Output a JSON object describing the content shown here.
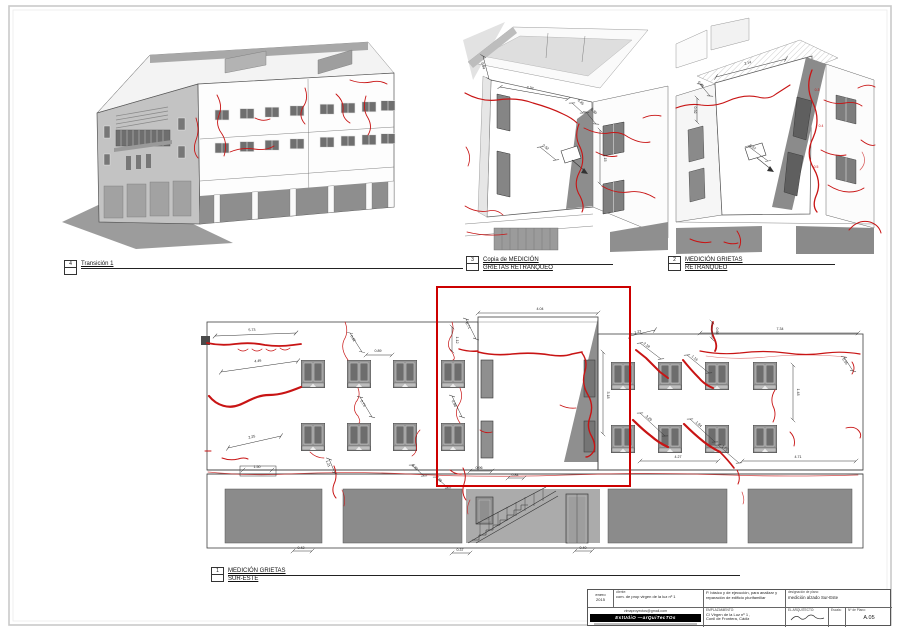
{
  "labels": {
    "view4": {
      "num": "4",
      "line1": "Transición 1",
      "line2": ""
    },
    "view3": {
      "num": "3",
      "line1": "Copia de MEDICIÓN",
      "line2": "GRIETAS RETRANQUEO"
    },
    "view2": {
      "num": "2",
      "line1": "MEDICIÓN GRIETAS",
      "line2": "RETRANQUEO"
    },
    "view1": {
      "num": "1",
      "line1": "MEDICIÓN GRIETAS",
      "line2": "SUR-ESTE"
    }
  },
  "titleblock": {
    "date_line1": "enero",
    "date_line2": "2015",
    "client_label": "cliente:",
    "client": "com. de prop virgen de la luz nº 1",
    "project_line1": "P. básico y de ejecución, para analizar y",
    "project_line2": "reparación de edificio plurifamiliar",
    "designation_label": "designación de plano:",
    "designation": "medición alzado Sur-Este",
    "email": "vimaproyectos@gmail.com",
    "studio": "EstUdiO —arQuiTecTOs",
    "site_label": "EMPLAZAMIENTO:",
    "site_line1": "C/ Virgen de la Luz nº 1 ,",
    "site_line2": "Conil de Frontera, Cádiz",
    "architect_label": "EL ARQUITECTO:",
    "scale_label": "Escala:",
    "sheet_no_label": "Nº de Plano:",
    "sheet_no": "A.05"
  },
  "colors": {
    "crack": "#c81414",
    "highlight": "#cc0000",
    "storefront": "#8b8b8b",
    "frame": "#c9c9c9"
  },
  "dims": {
    "elevation": [
      {
        "x1": 215,
        "y1": 336,
        "x2": 296,
        "y2": 333,
        "lx": 252,
        "ly": 331,
        "r": -2,
        "v": "5.73"
      },
      {
        "x1": 221,
        "y1": 372,
        "x2": 298,
        "y2": 361,
        "lx": 258,
        "ly": 362,
        "r": -8,
        "v": "4.46"
      },
      {
        "x1": 228,
        "y1": 448,
        "x2": 281,
        "y2": 436,
        "lx": 252,
        "ly": 438,
        "r": -13,
        "v": "2.25"
      },
      {
        "x1": 243,
        "y1": 470,
        "x2": 272,
        "y2": 470,
        "lx": 257,
        "ly": 468,
        "r": 0,
        "v": "1.50"
      },
      {
        "x1": 350,
        "y1": 333,
        "x2": 362,
        "y2": 352,
        "lx": 352,
        "ly": 339,
        "r": 60,
        "v": "0.62"
      },
      {
        "x1": 366,
        "y1": 355,
        "x2": 392,
        "y2": 355,
        "lx": 378,
        "ly": 352,
        "r": 0,
        "v": "0.89"
      },
      {
        "x1": 452,
        "y1": 327,
        "x2": 452,
        "y2": 351,
        "lx": 456,
        "ly": 340,
        "r": 90,
        "v": "1.12"
      },
      {
        "x1": 360,
        "y1": 397,
        "x2": 372,
        "y2": 417,
        "lx": 362,
        "ly": 404,
        "r": 58,
        "v": "0.73"
      },
      {
        "x1": 452,
        "y1": 396,
        "x2": 462,
        "y2": 417,
        "lx": 453,
        "ly": 404,
        "r": 64,
        "v": "0.98"
      },
      {
        "x1": 478,
        "y1": 313,
        "x2": 598,
        "y2": 313,
        "lx": 540,
        "ly": 310,
        "r": 0,
        "v": "4.04"
      },
      {
        "x1": 603,
        "y1": 352,
        "x2": 603,
        "y2": 434,
        "lx": 607,
        "ly": 395,
        "r": 90,
        "v": "3.18"
      },
      {
        "x1": 466,
        "y1": 319,
        "x2": 476,
        "y2": 339,
        "lx": 467,
        "ly": 326,
        "r": 62,
        "v": "0.71"
      },
      {
        "x1": 700,
        "y1": 333,
        "x2": 858,
        "y2": 333,
        "lx": 780,
        "ly": 330,
        "r": 0,
        "v": "7.34"
      },
      {
        "x1": 640,
        "y1": 461,
        "x2": 718,
        "y2": 461,
        "lx": 678,
        "ly": 458,
        "r": 0,
        "v": "4.27"
      },
      {
        "x1": 742,
        "y1": 461,
        "x2": 856,
        "y2": 461,
        "lx": 798,
        "ly": 458,
        "r": 0,
        "v": "4.71"
      },
      {
        "x1": 640,
        "y1": 343,
        "x2": 661,
        "y2": 359,
        "lx": 646,
        "ly": 346,
        "r": 37,
        "v": "2.18"
      },
      {
        "x1": 687,
        "y1": 355,
        "x2": 709,
        "y2": 373,
        "lx": 694,
        "ly": 359,
        "r": 39,
        "v": "1.16"
      },
      {
        "x1": 640,
        "y1": 413,
        "x2": 665,
        "y2": 436,
        "lx": 648,
        "ly": 419,
        "r": 42,
        "v": "3.29"
      },
      {
        "x1": 690,
        "y1": 419,
        "x2": 715,
        "y2": 442,
        "lx": 698,
        "ly": 425,
        "r": 42,
        "v": "1.94"
      },
      {
        "x1": 718,
        "y1": 445,
        "x2": 739,
        "y2": 463,
        "lx": 724,
        "ly": 449,
        "r": 41,
        "v": "1.75"
      },
      {
        "x1": 630,
        "y1": 336,
        "x2": 655,
        "y2": 330,
        "lx": 638,
        "ly": 333,
        "r": -12,
        "v": "1.23"
      },
      {
        "x1": 793,
        "y1": 365,
        "x2": 793,
        "y2": 420,
        "lx": 797,
        "ly": 392,
        "r": 90,
        "v": "1.48"
      },
      {
        "x1": 844,
        "y1": 357,
        "x2": 853,
        "y2": 371,
        "lx": 844,
        "ly": 362,
        "r": 55,
        "v": "0.55"
      },
      {
        "x1": 470,
        "y1": 471,
        "x2": 492,
        "y2": 471,
        "lx": 479,
        "ly": 469,
        "r": 0,
        "v": "0.96"
      },
      {
        "x1": 329,
        "y1": 459,
        "x2": 335,
        "y2": 473,
        "lx": 327,
        "ly": 464,
        "r": 68,
        "v": "1.21"
      },
      {
        "x1": 412,
        "y1": 465,
        "x2": 424,
        "y2": 476,
        "lx": 414,
        "ly": 468,
        "r": 40,
        "v": "0.30"
      },
      {
        "x1": 436,
        "y1": 477,
        "x2": 448,
        "y2": 488,
        "lx": 438,
        "ly": 480,
        "r": 42,
        "v": "0.38"
      },
      {
        "x1": 712,
        "y1": 322,
        "x2": 712,
        "y2": 339,
        "lx": 716,
        "ly": 331,
        "r": 90,
        "v": "0.66"
      },
      {
        "x1": 293,
        "y1": 551,
        "x2": 312,
        "y2": 551,
        "lx": 301,
        "ly": 549,
        "r": 0,
        "v": "0.42"
      },
      {
        "x1": 452,
        "y1": 553,
        "x2": 470,
        "y2": 553,
        "lx": 460,
        "ly": 551,
        "r": 0,
        "v": "0.37"
      },
      {
        "x1": 575,
        "y1": 551,
        "x2": 592,
        "y2": 551,
        "lx": 583,
        "ly": 549,
        "r": 0,
        "v": "0.40"
      },
      {
        "x1": 508,
        "y1": 478,
        "x2": 524,
        "y2": 478,
        "lx": 515,
        "ly": 476,
        "r": 0,
        "v": "0.84"
      }
    ],
    "view2": [
      {
        "x1": 500,
        "y1": 87,
        "x2": 568,
        "y2": 99,
        "lx": 530,
        "ly": 89,
        "r": 10,
        "v": "2.32"
      },
      {
        "x1": 572,
        "y1": 103,
        "x2": 583,
        "y2": 113,
        "lx": 580,
        "ly": 103,
        "r": 40,
        "v": "0.45"
      },
      {
        "x1": 586,
        "y1": 112,
        "x2": 596,
        "y2": 124,
        "lx": 593,
        "ly": 112,
        "r": 45,
        "v": "0.30"
      },
      {
        "x1": 600,
        "y1": 130,
        "x2": 600,
        "y2": 184,
        "lx": 604,
        "ly": 158,
        "r": 90,
        "v": "1.15"
      },
      {
        "x1": 483,
        "y1": 56,
        "x2": 489,
        "y2": 79,
        "lx": 482,
        "ly": 66,
        "r": 75,
        "v": "0.84"
      },
      {
        "x1": 540,
        "y1": 147,
        "x2": 556,
        "y2": 160,
        "lx": 545,
        "ly": 148,
        "r": 38,
        "v": "0.52"
      }
    ],
    "view3": [
      {
        "x1": 716,
        "y1": 77,
        "x2": 786,
        "y2": 59,
        "lx": 748,
        "ly": 64,
        "r": -14,
        "v": "2.14"
      },
      {
        "x1": 700,
        "y1": 84,
        "x2": 710,
        "y2": 96,
        "lx": 700,
        "ly": 85,
        "r": 48,
        "v": "0.48"
      },
      {
        "x1": 697,
        "y1": 98,
        "x2": 697,
        "y2": 122,
        "lx": 694,
        "ly": 110,
        "r": 90,
        "v": "0.92"
      },
      {
        "x1": 748,
        "y1": 146,
        "x2": 768,
        "y2": 161,
        "lx": 752,
        "ly": 148,
        "r": 36,
        "v": "0.57"
      },
      {
        "lx": 817,
        "ly": 91,
        "v": "0.3",
        "red": true
      },
      {
        "lx": 821,
        "ly": 127,
        "v": "0.4",
        "red": true
      },
      {
        "lx": 816,
        "ly": 168,
        "v": "0.5",
        "red": true
      }
    ]
  }
}
